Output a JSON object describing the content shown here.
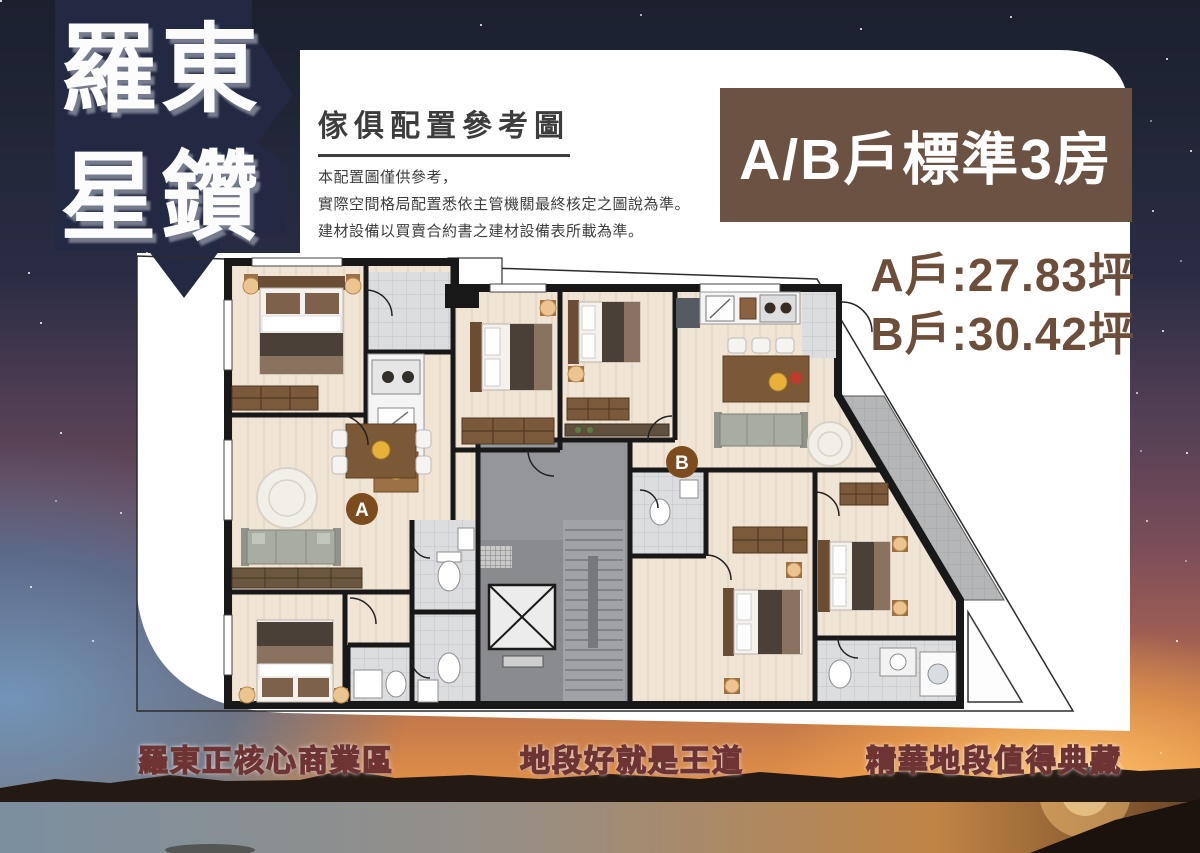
{
  "logo": {
    "line1": "羅東",
    "line2": "星鑽"
  },
  "header": {
    "title": "傢俱配置參考圖",
    "disclaimer": [
      "本配置圖僅供參考，",
      "實際空間格局配置悉依主管機關最終核定之圖說為準。",
      "建材設備以買賣合約書之建材設備表所載為準。"
    ]
  },
  "unit_banner": {
    "label": "A/B戶標準3房"
  },
  "unit_areas": {
    "a": "A戶:27.83坪",
    "b": "B戶:30.42坪"
  },
  "floor_plan": {
    "markers": {
      "a": "A",
      "b": "B"
    }
  },
  "slogans": {
    "left": "羅東正核心商業區",
    "center": "地段好就是王道",
    "right": "精華地段值得典藏"
  },
  "colors": {
    "banner_bg": "#6b5243",
    "area_text": "#6d4e3b",
    "marker_brown": "#7d4c1e",
    "slogan_outline": "#6e3434",
    "sky_navy": "#20253a",
    "sunset_orange": "#e89449",
    "floor_beige": "#f0e4d4",
    "wall_black": "#181818"
  }
}
